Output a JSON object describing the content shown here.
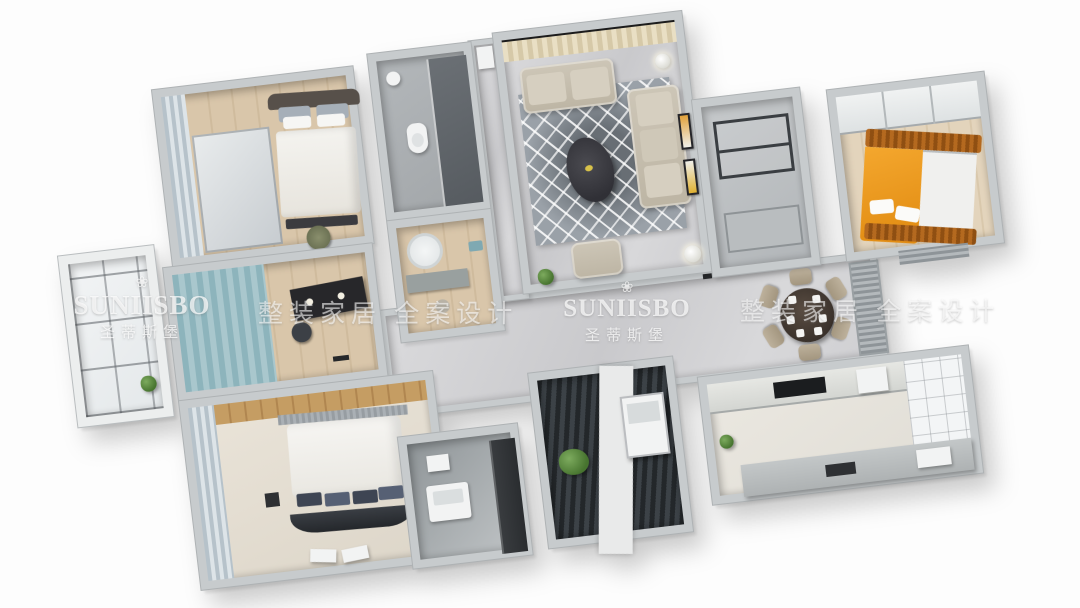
{
  "watermarks": {
    "lotus_icon": "❀",
    "brand_latin": "SUNIISBO",
    "brand_cn": "圣蒂斯堡",
    "slogan": "整装家居 全案设计"
  },
  "palette": {
    "background": "#fdfdfd",
    "wall": "#c7cbcd",
    "wood_floor": "#d6c2a5",
    "marble_floor": "#d6d6d8",
    "rug_gray": "#9aa1a8",
    "teal_accent": "#86afb8",
    "orange_accent": "#ec9c22",
    "sofa_beige": "#c8c1b0",
    "dark_furniture": "#2e3033",
    "curtain_cream": "#e6dcc0",
    "watermark_white": "#ffffff"
  }
}
